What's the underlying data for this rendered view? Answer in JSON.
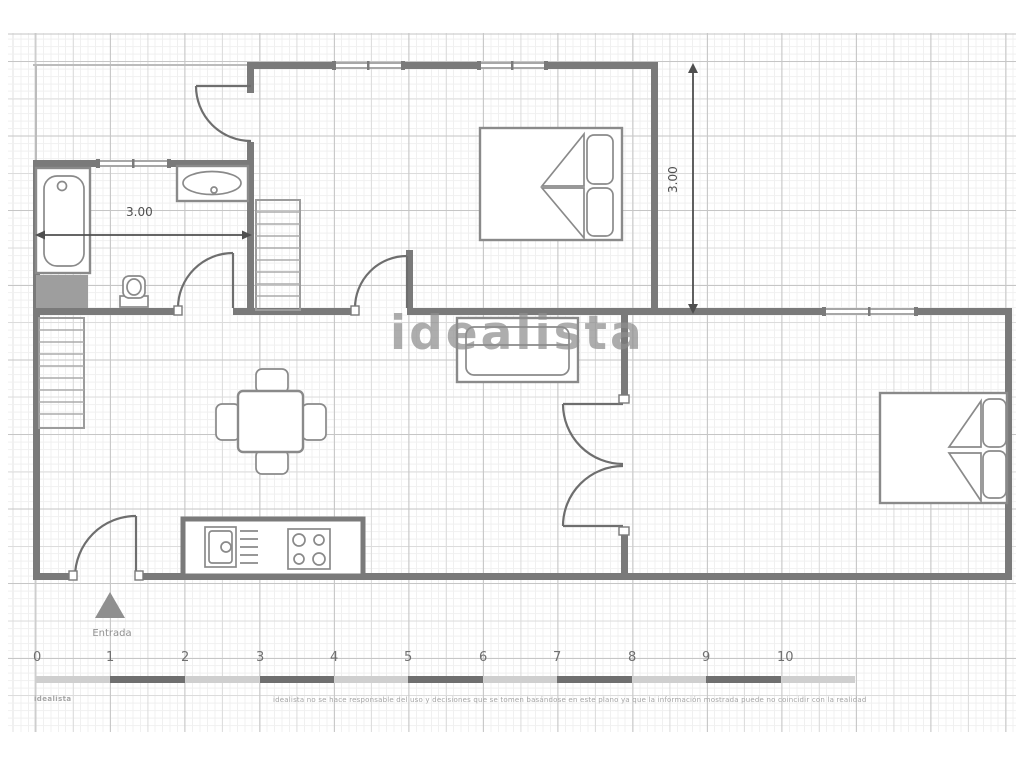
{
  "watermark": "idealista",
  "dimensions": {
    "bathroom_width": "3.00",
    "bedroom_height": "3.00"
  },
  "entrance": {
    "label": "Entrada"
  },
  "scale_ruler": {
    "numbers": [
      "0",
      "1",
      "2",
      "3",
      "4",
      "5",
      "6",
      "7",
      "8",
      "9",
      "10"
    ]
  },
  "footer": {
    "brand": "idealista",
    "disclaimer": "idealista no se hace responsable del uso y decisiones que se tomen basándose en este plano ya que la información mostrada puede no coincidir con la realidad"
  },
  "colors": {
    "wall": "#7a7a7a",
    "fixture": "#8a8a8a",
    "door": "#6e6e6e",
    "dim": "#4f4f4f",
    "watermark": "#8e8e8e",
    "terrace": "#bcbcbc",
    "block": "#9e9e9e",
    "ruler_light": "#cfcfcf",
    "ruler_dark": "#6f6f6f",
    "muted": "#a5a5a5",
    "grid_strong": "#c6c6c6",
    "grid_mid": "#dcdcdc",
    "grid_fine": "#f0f0f0"
  }
}
